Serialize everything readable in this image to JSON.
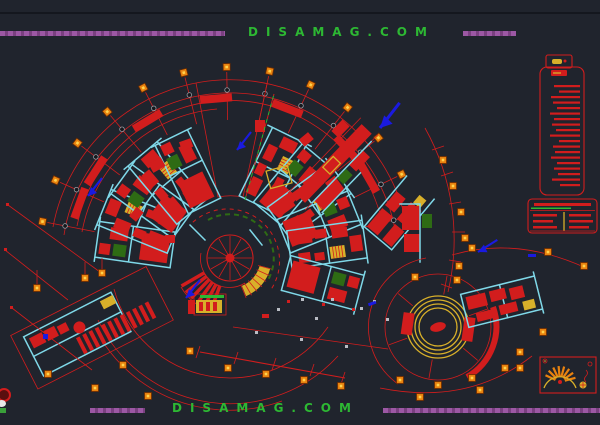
{
  "watermarks": {
    "top": "DISAMAG.COM",
    "bottom": "DISAMAG.COM"
  },
  "colors": {
    "background": "#20242d",
    "red": "#d21d1d",
    "cyan": "#7fd8e8",
    "yellow": "#d8b02a",
    "orange": "#e8820f",
    "purple": "#9c58a4",
    "green": "#2db833",
    "dark-green": "#2e6b14",
    "blue": "#1a1ae0",
    "gray": "#b9bcc4"
  },
  "legend": {
    "note_line_count": 19
  },
  "spec_table": {
    "columns": 2,
    "body_rows": 3
  }
}
